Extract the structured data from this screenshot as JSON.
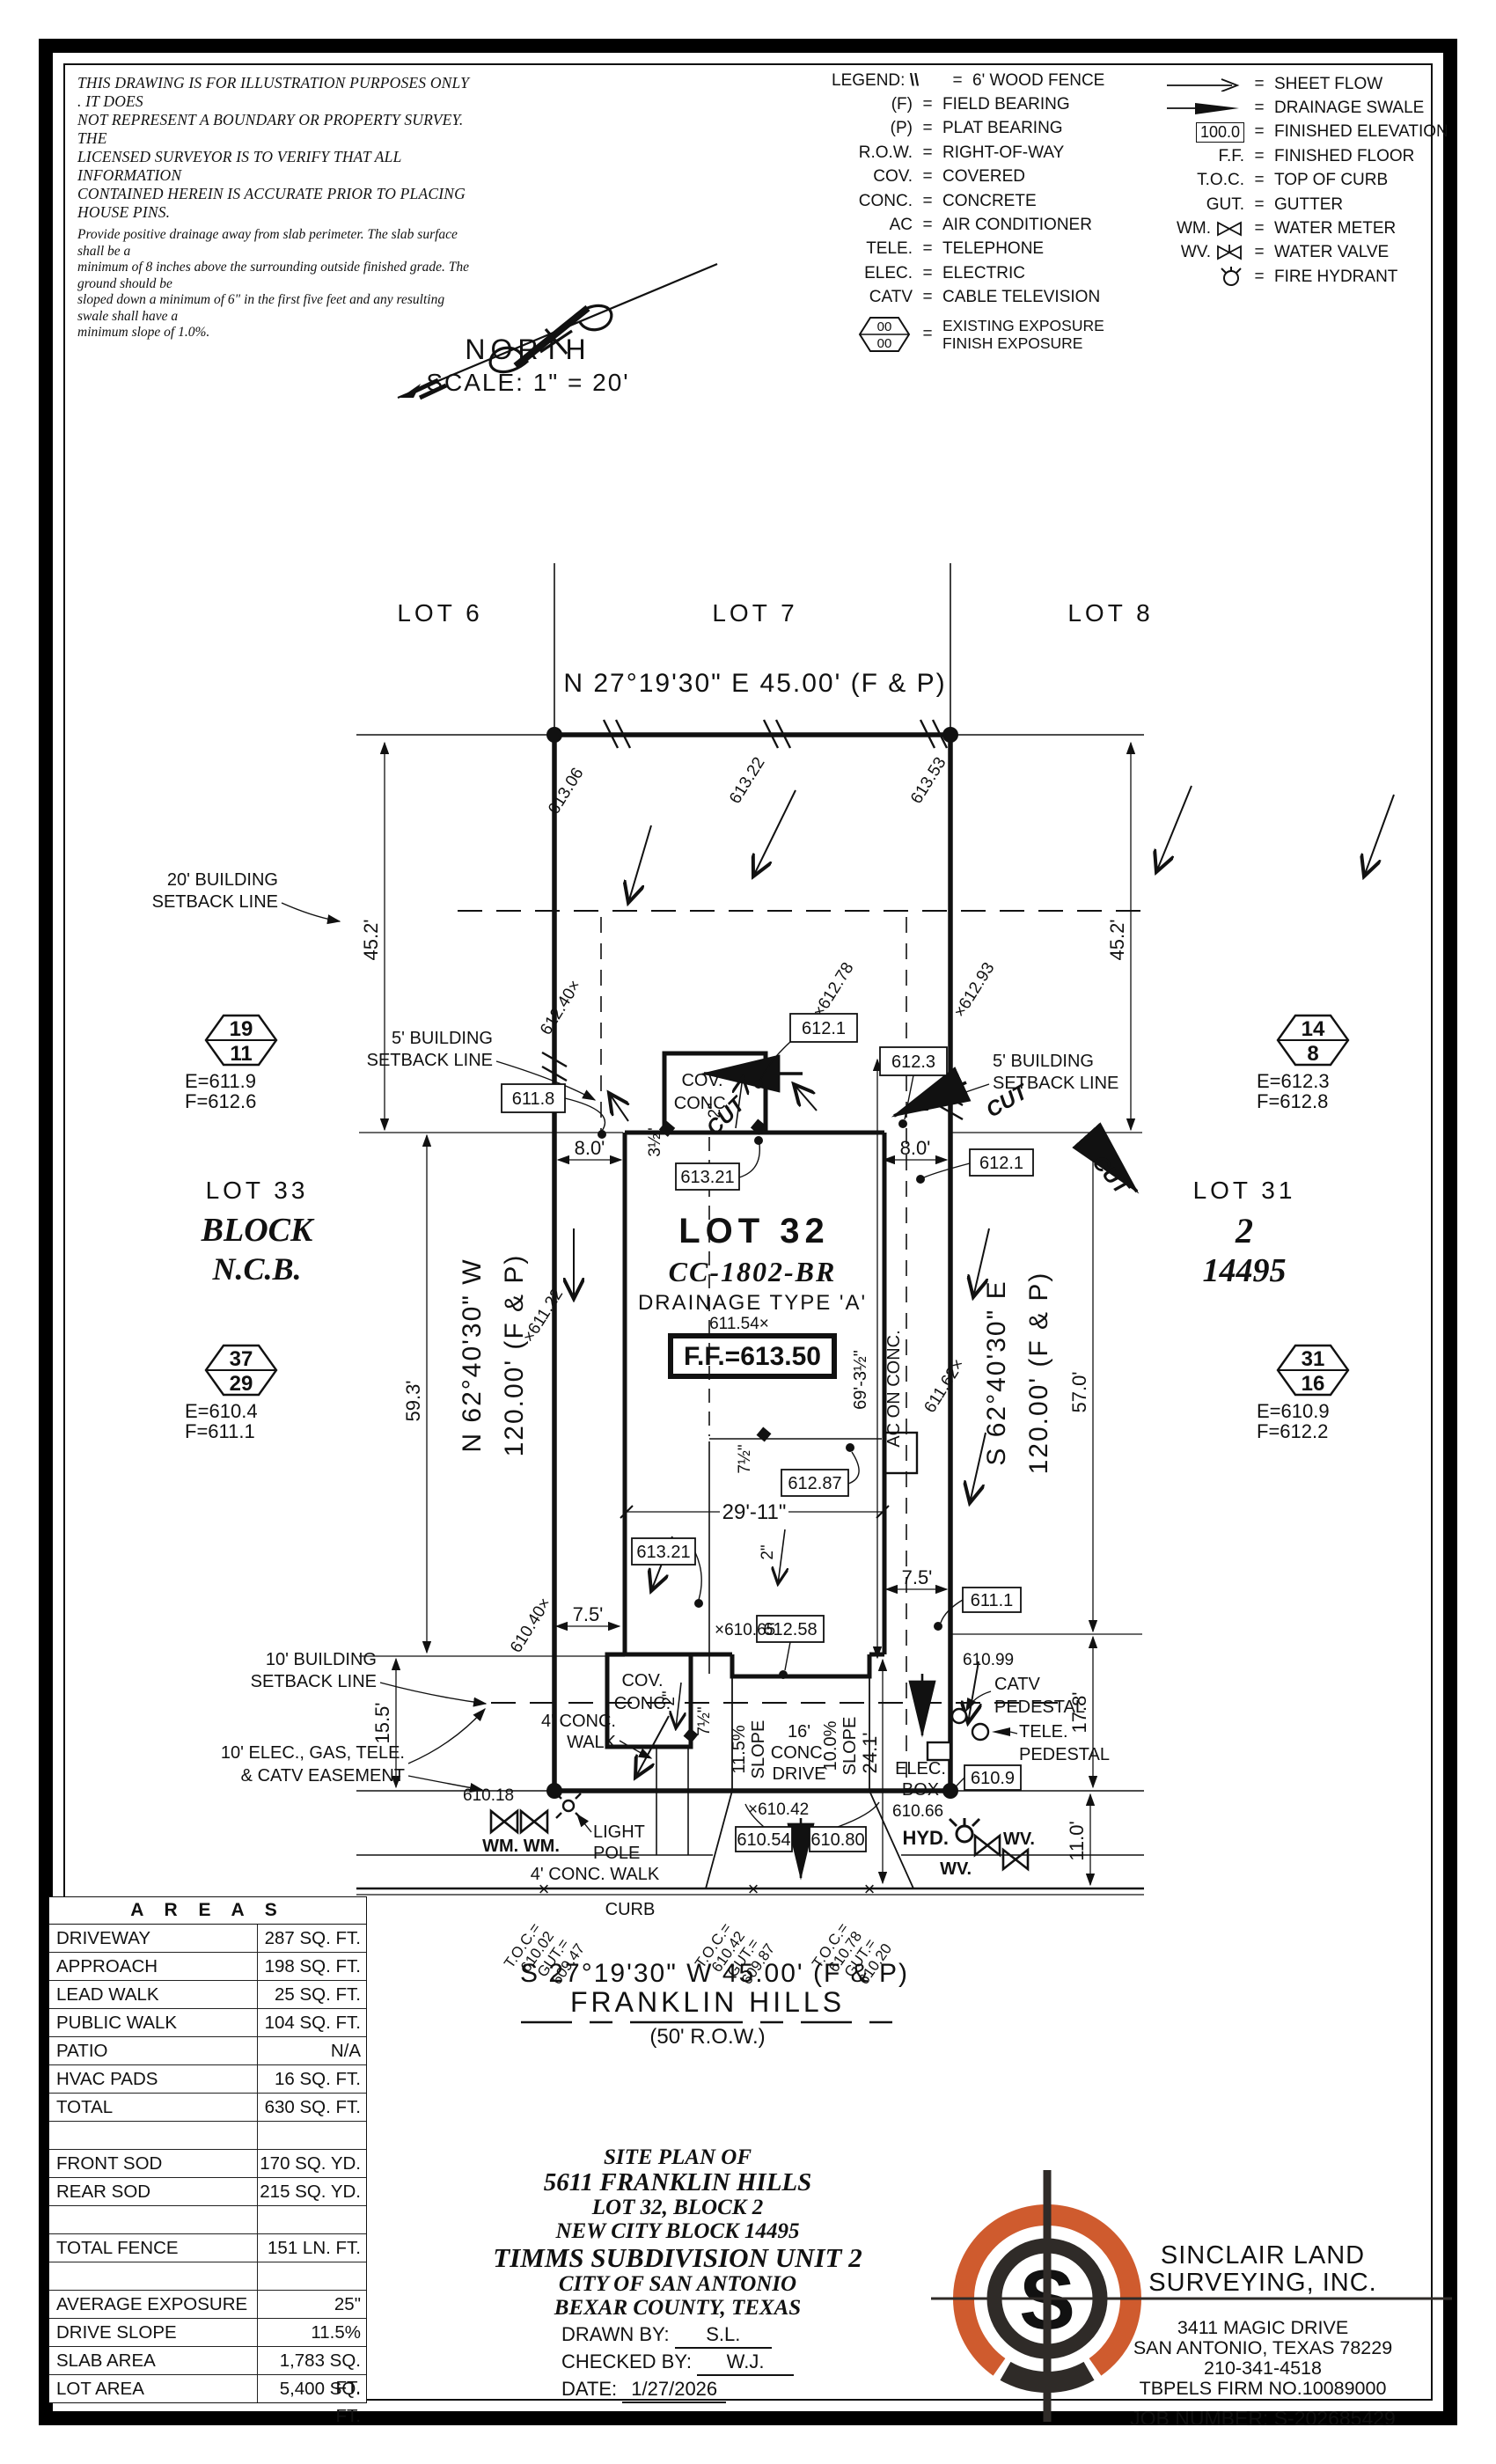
{
  "colors": {
    "ink": "#111111",
    "accent_orange": "#cf5b2e",
    "logo_dark": "#2f2b28"
  },
  "disclaimer": {
    "para1_lines": [
      "THIS DRAWING IS FOR ILLUSTRATION PURPOSES ONLY . IT DOES",
      "NOT REPRESENT A BOUNDARY OR PROPERTY SURVEY. THE",
      "LICENSED SURVEYOR IS TO VERIFY THAT ALL INFORMATION",
      "CONTAINED HEREIN IS ACCURATE PRIOR TO PLACING HOUSE PINS."
    ],
    "para2_lines": [
      "Provide positive drainage away from slab perimeter. The slab surface shall be a",
      "minimum of 8 inches above the surrounding outside finished grade. The ground should be",
      "sloped down a minimum of 6\" in the first five feet and any resulting swale shall have a",
      "minimum slope of 1.0%."
    ]
  },
  "legend": {
    "title": "LEGEND:",
    "eq": "=",
    "elev_box": "100.0",
    "left": [
      {
        "sym": "\\\\",
        "label": "6' WOOD FENCE"
      },
      {
        "sym": "(F)",
        "label": "FIELD BEARING"
      },
      {
        "sym": "(P)",
        "label": "PLAT BEARING"
      },
      {
        "sym": "R.O.W.",
        "label": "RIGHT-OF-WAY"
      },
      {
        "sym": "COV.",
        "label": "COVERED"
      },
      {
        "sym": "CONC.",
        "label": "CONCRETE"
      },
      {
        "sym": "AC",
        "label": "AIR CONDITIONER"
      },
      {
        "sym": "TELE.",
        "label": "TELEPHONE"
      },
      {
        "sym": "ELEC.",
        "label": "ELECTRIC"
      },
      {
        "sym": "CATV",
        "label": "CABLE TELEVISION"
      }
    ],
    "exposure": {
      "top": "00",
      "bottom": "00",
      "line1": "EXISTING EXPOSURE",
      "line2": "FINISH EXPOSURE"
    },
    "right": [
      {
        "sym": "",
        "label": "SHEET FLOW"
      },
      {
        "sym": "",
        "label": "DRAINAGE SWALE"
      },
      {
        "sym": "",
        "label": "FINISHED ELEVATION"
      },
      {
        "sym": "F.F.",
        "label": "FINISHED FLOOR"
      },
      {
        "sym": "T.O.C.",
        "label": "TOP OF CURB"
      },
      {
        "sym": "GUT.",
        "label": "GUTTER"
      },
      {
        "sym": "WM.",
        "label": "WATER METER"
      },
      {
        "sym": "WV.",
        "label": "WATER VALVE"
      },
      {
        "sym": "",
        "label": "FIRE HYDRANT"
      }
    ]
  },
  "north": {
    "label": "NORTH",
    "scale": "SCALE: 1\" = 20'"
  },
  "plan": {
    "lot6": "LOT 6",
    "lot7": "LOT 7",
    "lot8": "LOT 8",
    "bearing_rear": "N 27°19'30\" E  45.00' (F & P)",
    "bearing_front": "S 27°19'30\" W  45.00' (F & P)",
    "bearing_left_1": "N 62°40'30\" W",
    "bearing_left_2": "120.00' (F & P)",
    "bearing_right_1": "S 62°40'30\" E",
    "bearing_right_2": "120.00' (F & P)",
    "street_name": "FRANKLIN HILLS",
    "street_row": "(50' R.O.W.)",
    "lot32": "LOT 32",
    "plan_code": "CC-1802-BR",
    "drainage": "DRAINAGE TYPE 'A'",
    "ff_elev": "F.F.=613.50",
    "lot33": "LOT 33",
    "block_word": "BLOCK",
    "ncb_word": "N.C.B.",
    "lot31": "LOT 31",
    "block_num": "2",
    "ncb_num": "14495",
    "setback20_1": "20' BUILDING",
    "setback5_1": "5' BUILDING",
    "setback10_1": "10' BUILDING",
    "setback_line": "SETBACK LINE",
    "easement_1": "10' ELEC., GAS, TELE.",
    "easement_2": "& CATV EASEMENT",
    "cov": "COV.",
    "conc": "CONC.",
    "ac_on_conc": "AC ON CONC.",
    "cut": "CUT",
    "dim_452": "45.2'",
    "dim_593": "59.3'",
    "dim_570": "57.0'",
    "dim_155": "15.5'",
    "dim_178": "17.8'",
    "dim_110": "11.0'",
    "dim_80": "8.0'",
    "dim_2911": "29'-11\"",
    "dim_241": "24.1'",
    "dim_75": "7.5'",
    "dim_693": "69'-3½\"",
    "dim_2in": "2\"",
    "dim_35in": "3½\"",
    "dim_75in": "7½\"",
    "slope_115": "11.5%",
    "slope_100": "10.0%",
    "slope_word": "SLOPE",
    "drive_16": "16'",
    "drive_conc": "CONC.",
    "drive_word": "DRIVE",
    "walk4": "4' CONC.",
    "walk_word": "WALK",
    "walk4_full": "4' CONC. WALK",
    "curb": "CURB",
    "light_1": "LIGHT",
    "light_2": "POLE",
    "hyd": "HYD.",
    "wm2": "WM. WM.",
    "wv": "WV.",
    "catv": "CATV",
    "tele": "TELE.",
    "pedestal": "PEDESTAL",
    "elec": "ELEC.",
    "box_word": "BOX",
    "ev_6118": "611.8",
    "ev_6121": "612.1",
    "ev_6123": "612.3",
    "ev_61321": "613.21",
    "ev_61287": "612.87",
    "ev_61258": "612.58",
    "ev_6111": "611.1",
    "ev_6109": "610.9",
    "ev_61054": "610.54",
    "ev_61080": "610.80",
    "ev_61306": "613.06",
    "ev_61322": "613.22",
    "ev_61353": "613.53",
    "ev_61240": "612.40×",
    "ev_61278": "×612.78",
    "ev_61293": "×612.93",
    "ev_61154": "611.54×",
    "ev_61122": "×611.22",
    "ev_61162": "611.62×",
    "ev_61040": "610.40×",
    "ev_61065": "×610.65",
    "ev_61018": "610.18",
    "ev_61042": "×610.42",
    "ev_61066": "610.66",
    "ev_61099": "610.99",
    "toc_eq": "T.O.C.=",
    "gut_eq": "GUT.=",
    "toc_1": "610.02",
    "gut_1": "609.47",
    "toc_2": "610.42",
    "gut_2": "609.87",
    "toc_3": "610.78",
    "gut_3": "610.20",
    "xmark": "×",
    "hex_19": "19",
    "hex_11": "11",
    "hex_37": "37",
    "hex_29": "29",
    "hex_14": "14",
    "hex_8": "8",
    "hex_31": "31",
    "hex_16": "16",
    "ef_1a": "E=611.9",
    "ef_1b": "F=612.6",
    "ef_2a": "E=610.4",
    "ef_2b": "F=611.1",
    "ef_3a": "E=612.3",
    "ef_3b": "F=612.8",
    "ef_4a": "E=610.9",
    "ef_4b": "F=612.2"
  },
  "areas": {
    "title": "A R E A S",
    "rows": [
      {
        "label": "DRIVEWAY",
        "value": "287 SQ. FT."
      },
      {
        "label": "APPROACH",
        "value": "198 SQ. FT."
      },
      {
        "label": "LEAD WALK",
        "value": "25 SQ. FT."
      },
      {
        "label": "PUBLIC WALK",
        "value": "104 SQ. FT."
      },
      {
        "label": "PATIO",
        "value": "N/A"
      },
      {
        "label": "HVAC PADS",
        "value": "16 SQ. FT."
      },
      {
        "label": "TOTAL",
        "value": "630 SQ. FT."
      },
      {
        "label": "",
        "value": ""
      },
      {
        "label": "FRONT SOD",
        "value": "170 SQ. YD."
      },
      {
        "label": "REAR SOD",
        "value": "215 SQ. YD."
      },
      {
        "label": "",
        "value": ""
      },
      {
        "label": "TOTAL FENCE",
        "value": "151 LN. FT."
      },
      {
        "label": "",
        "value": ""
      },
      {
        "label": "AVERAGE EXPOSURE",
        "value": "25\""
      },
      {
        "label": "DRIVE SLOPE",
        "value": "11.5%"
      },
      {
        "label": "SLAB AREA",
        "value": "1,783 SQ. FT."
      },
      {
        "label": "LOT AREA",
        "value": "5,400 SQ. FT."
      }
    ]
  },
  "title_block": {
    "l1": "SITE PLAN OF",
    "l2": "5611 FRANKLIN HILLS",
    "l3": "LOT 32, BLOCK 2",
    "l4": "NEW CITY BLOCK 14495",
    "l5": "TIMMS SUBDIVISION UNIT 2",
    "l6": "CITY OF SAN ANTONIO",
    "l7": "BEXAR COUNTY, TEXAS",
    "drawn_label": "DRAWN BY:",
    "drawn": "S.L.",
    "checked_label": "CHECKED BY:",
    "checked": "W.J.",
    "date_label": "DATE:",
    "date": "1/27/2026"
  },
  "firm": {
    "logo_letter": "S",
    "name1": "SINCLAIR LAND",
    "name2": "SURVEYING, INC.",
    "addr1": "3411 MAGIC DRIVE",
    "addr2": "SAN ANTONIO, TEXAS 78229",
    "phone": "210-341-4518",
    "tbpels": "TBPELS FIRM NO.10089000",
    "job": "JOB NUMBER: S-202685429"
  }
}
